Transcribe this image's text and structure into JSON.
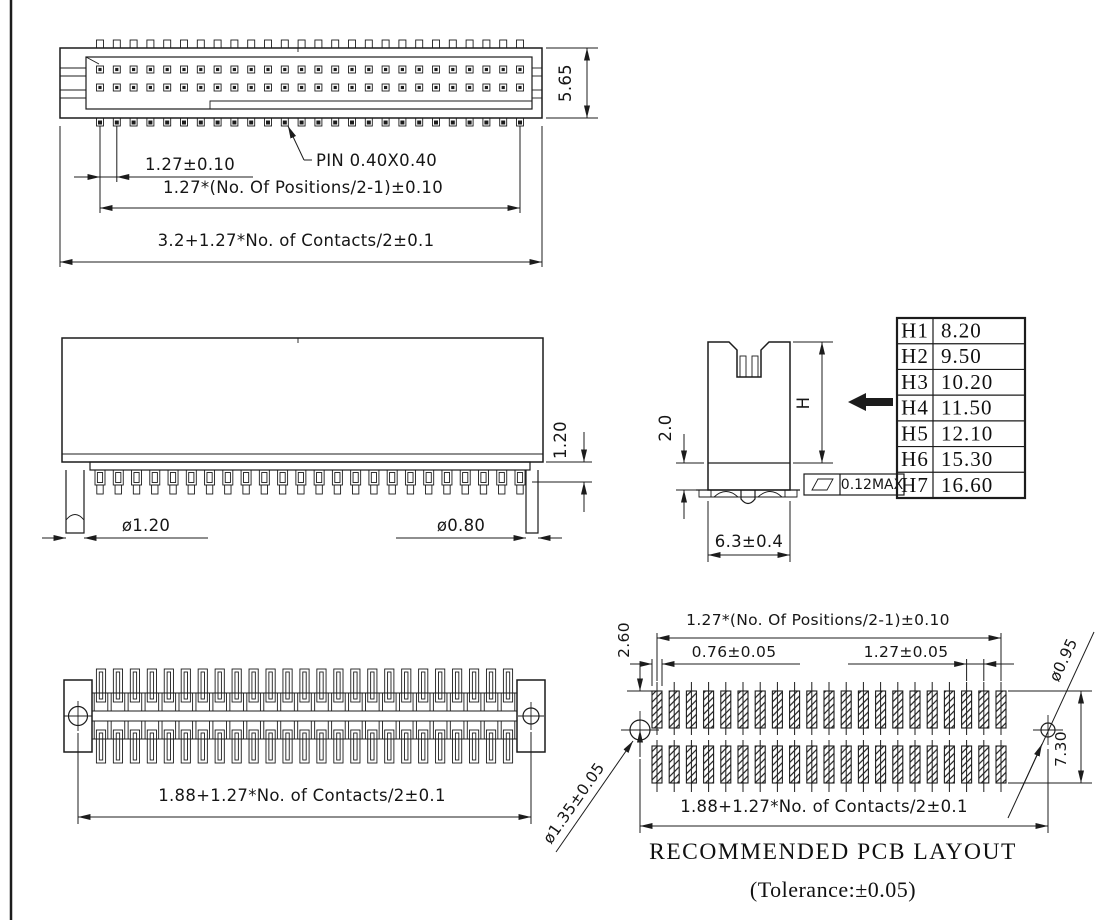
{
  "line_color": "#1c1c1c",
  "top_view": {
    "dim_pin_pitch": "1.27±0.10",
    "pin_label": "PIN 0.40X0.40",
    "dim_positions": "1.27*(No. Of Positions/2-1)±0.10",
    "dim_overall": "3.2+1.27*No. of Contacts/2±0.1",
    "dim_height": "5.65",
    "pins_per_row": 26,
    "pin_rows": 2
  },
  "front_view": {
    "dim_left_post": "ø1.20",
    "dim_right_post": "ø0.80",
    "dim_standoff": "1.20",
    "pin_count": 24
  },
  "side_view": {
    "dim_lower_body": "2.0",
    "height_label": "H",
    "flatness_value": "0.12MAX",
    "dim_width": "6.3±0.4"
  },
  "height_table": {
    "rows": [
      {
        "code": "H1",
        "value": "8.20"
      },
      {
        "code": "H2",
        "value": "9.50"
      },
      {
        "code": "H3",
        "value": "10.20"
      },
      {
        "code": "H4",
        "value": "11.50"
      },
      {
        "code": "H5",
        "value": "12.10"
      },
      {
        "code": "H6",
        "value": "15.30"
      },
      {
        "code": "H7",
        "value": "16.60"
      }
    ]
  },
  "bottom_view": {
    "dim_overall": "1.88+1.27*No. of Contacts/2±0.1",
    "slot_count": 25
  },
  "pcb_layout": {
    "dim_positions": "1.27*(No. Of Positions/2-1)±0.10",
    "dim_pad_width": "0.76±0.05",
    "dim_pitch": "1.27±0.05",
    "dim_pad_offset": "2.60",
    "dim_row_span": "7.30",
    "dim_hole_small": "ø0.95",
    "dim_hole_large": "ø1.35±0.05",
    "dim_overall": "1.88+1.27*No. of Contacts/2±0.1",
    "title": "RECOMMENDED PCB LAYOUT",
    "tolerance_note": "(Tolerance:±0.05)",
    "pads_per_row": 21,
    "pad_rows": 2
  }
}
